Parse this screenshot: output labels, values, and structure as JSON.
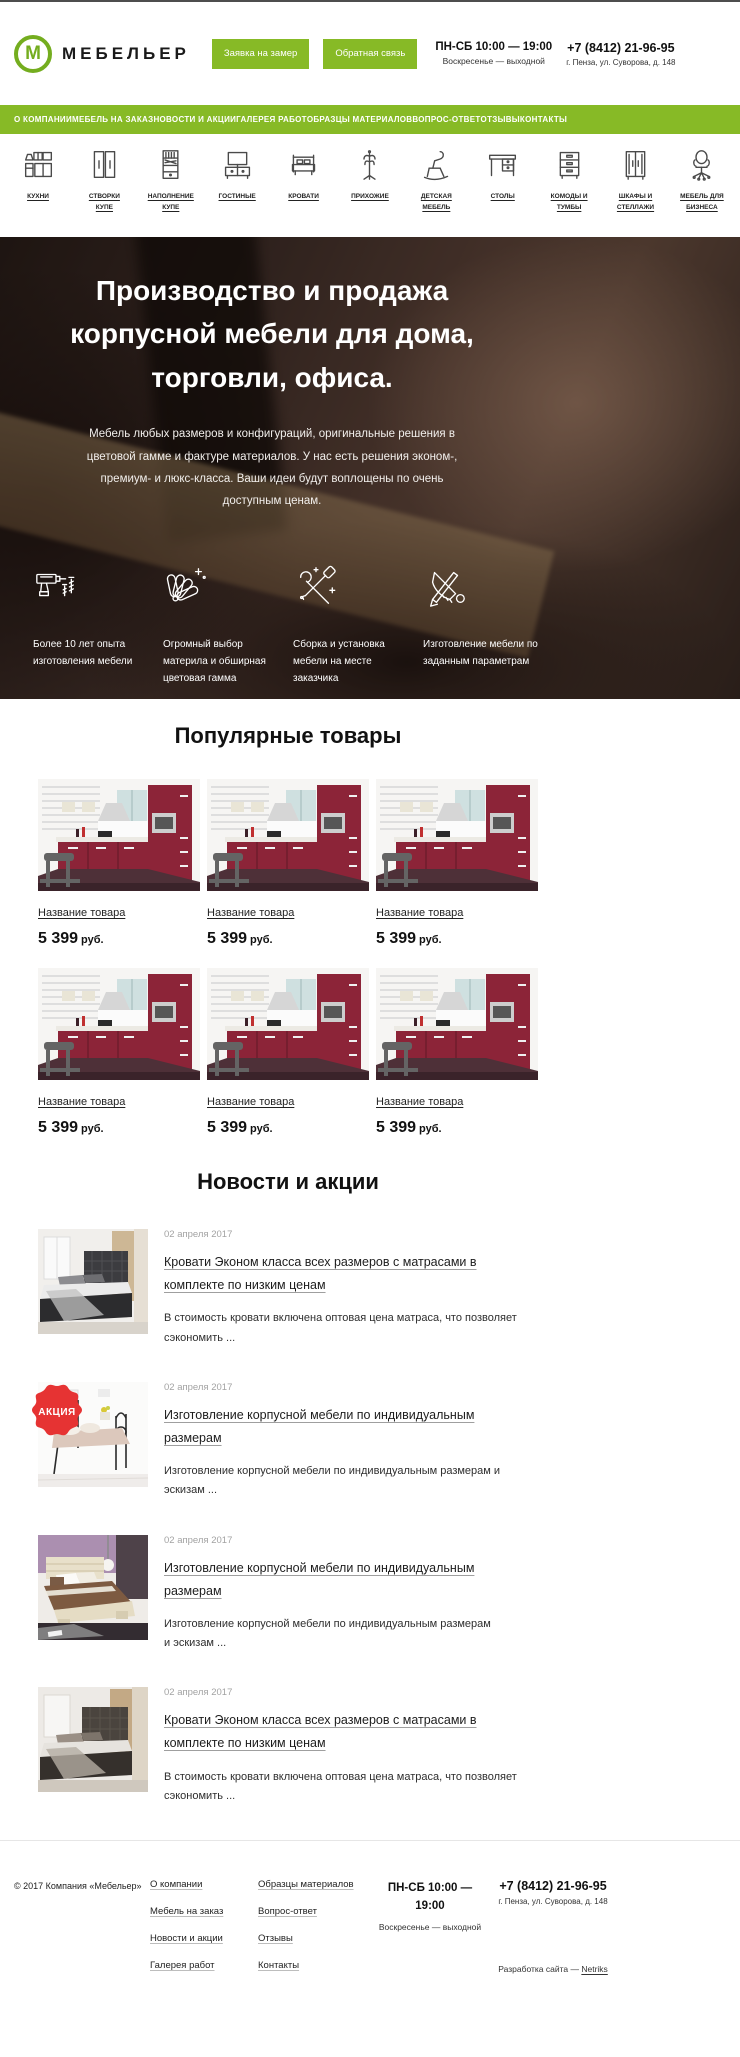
{
  "colors": {
    "accent_green": "#87ba26",
    "badge_red": "#e63333",
    "kitchen_red": "#8c2438"
  },
  "header": {
    "logo_letter": "М",
    "logo_text": "МЕБЕЛЬЕР",
    "request_button": "Заявка на замер",
    "feedback_button": "Обратная связь",
    "hours_line1": "ПН-СБ 10:00 — 19:00",
    "hours_line2": "Воскресенье — выходной",
    "phone": "+7 (8412) 21-96-95",
    "address": "г. Пенза, ул. Суворова, д. 148"
  },
  "nav": {
    "items": [
      "О КОМПАНИИ",
      "МЕБЕЛЬ НА ЗАКАЗ",
      "НОВОСТИ И АКЦИИ",
      "ГАЛЕРЕЯ РАБОТ",
      "ОБРАЗЦЫ МАТЕРИАЛОВ",
      "ВОПРОС-ОТВЕТ",
      "ОТЗЫВЫ",
      "КОНТАКТЫ"
    ]
  },
  "categories": {
    "items": [
      {
        "label": "КУХНИ",
        "icon": "kitchen-icon"
      },
      {
        "label": "СТВОРКИ КУПЕ",
        "icon": "sliding-doors-icon"
      },
      {
        "label": "НАПОЛНЕНИЕ КУПЕ",
        "icon": "wardrobe-filling-icon"
      },
      {
        "label": "ГОСТИНЫЕ",
        "icon": "living-room-icon"
      },
      {
        "label": "КРОВАТИ",
        "icon": "bed-icon"
      },
      {
        "label": "ПРИХОЖИЕ",
        "icon": "coat-rack-icon"
      },
      {
        "label": "ДЕТСКАЯ МЕБЕЛЬ",
        "icon": "kids-chair-icon"
      },
      {
        "label": "СТОЛЫ",
        "icon": "desk-icon"
      },
      {
        "label": "КОМОДЫ И ТУМБЫ",
        "icon": "commode-icon"
      },
      {
        "label": "ШКАФЫ И СТЕЛЛАЖИ",
        "icon": "wardrobe-icon"
      },
      {
        "label": "МЕБЕЛЬ ДЛЯ БИЗНЕСА",
        "icon": "office-chair-icon"
      }
    ]
  },
  "hero": {
    "title": "Производство и продажа корпусной мебели для дома, торговли, офиса.",
    "subtitle": "Мебель любых размеров и конфигураций, оригинальные решения в цветовой гамме и фактуре материалов. У нас есть решения эконом-, премиум- и люкс-класса. Ваши идеи будут воплощены по очень доступным ценам.",
    "features": [
      {
        "icon": "drill-icon",
        "text": "Более 10 лет опыта изготовления мебели"
      },
      {
        "icon": "palette-fan-icon",
        "text": "Огромный выбор материла и обширная цветовая гамма"
      },
      {
        "icon": "tools-icon",
        "text": "Сборка и установка мебели на месте заказчика"
      },
      {
        "icon": "saw-pencil-icon",
        "text": "Изготовление мебели по заданным параметрам"
      }
    ]
  },
  "products": {
    "title": "Популярные товары",
    "items": [
      {
        "name": "Название товара",
        "price": "5 399",
        "currency": "руб."
      },
      {
        "name": "Название товара",
        "price": "5 399",
        "currency": "руб."
      },
      {
        "name": "Название товара",
        "price": "5 399",
        "currency": "руб."
      },
      {
        "name": "Название товара",
        "price": "5 399",
        "currency": "руб."
      },
      {
        "name": "Название товара",
        "price": "5 399",
        "currency": "руб."
      },
      {
        "name": "Название товара",
        "price": "5 399",
        "currency": "руб."
      }
    ]
  },
  "news": {
    "title": "Новости и акции",
    "items": [
      {
        "date": "02 апреля 2017",
        "badge": "",
        "title": "Кровати Эконом класса всех размеров с матрасами в комплекте по низким ценам",
        "text": "В стоимость кровати включена оптовая цена матраса, что позволяет сэкономить ..."
      },
      {
        "date": "02 апреля 2017",
        "badge": "АКЦИЯ",
        "title": "Изготовление корпусной мебели по индивидуальным размерам",
        "text": "Изготовление корпусной мебели по индивидуальным размерам и эскизам ..."
      },
      {
        "date": "02 апреля 2017",
        "badge": "",
        "title": "Изготовление корпусной мебели по индивидуальным размерам",
        "text": "Изготовление корпусной мебели по индивидуальным размерам и эскизам ..."
      },
      {
        "date": "02 апреля 2017",
        "badge": "",
        "title": "Кровати Эконом класса всех размеров с матрасами в комплекте по низким ценам",
        "text": "В стоимость кровати включена оптовая цена матраса, что позволяет сэкономить ..."
      }
    ]
  },
  "footer": {
    "copyright": "© 2017 Компания «Мебельер»",
    "col1": [
      "О компании",
      "Мебель на заказ",
      "Новости и акции",
      "Галерея работ"
    ],
    "col2": [
      "Образцы материалов",
      "Вопрос-ответ",
      "Отзывы",
      "Контакты"
    ],
    "hours_line1": "ПН-СБ 10:00 — 19:00",
    "hours_line2": "Воскресенье — выходной",
    "phone": "+7 (8412) 21-96-95",
    "address": "г. Пенза, ул. Суворова, д. 148",
    "dev_prefix": "Разработка сайта — ",
    "dev_link": "Netriks"
  }
}
